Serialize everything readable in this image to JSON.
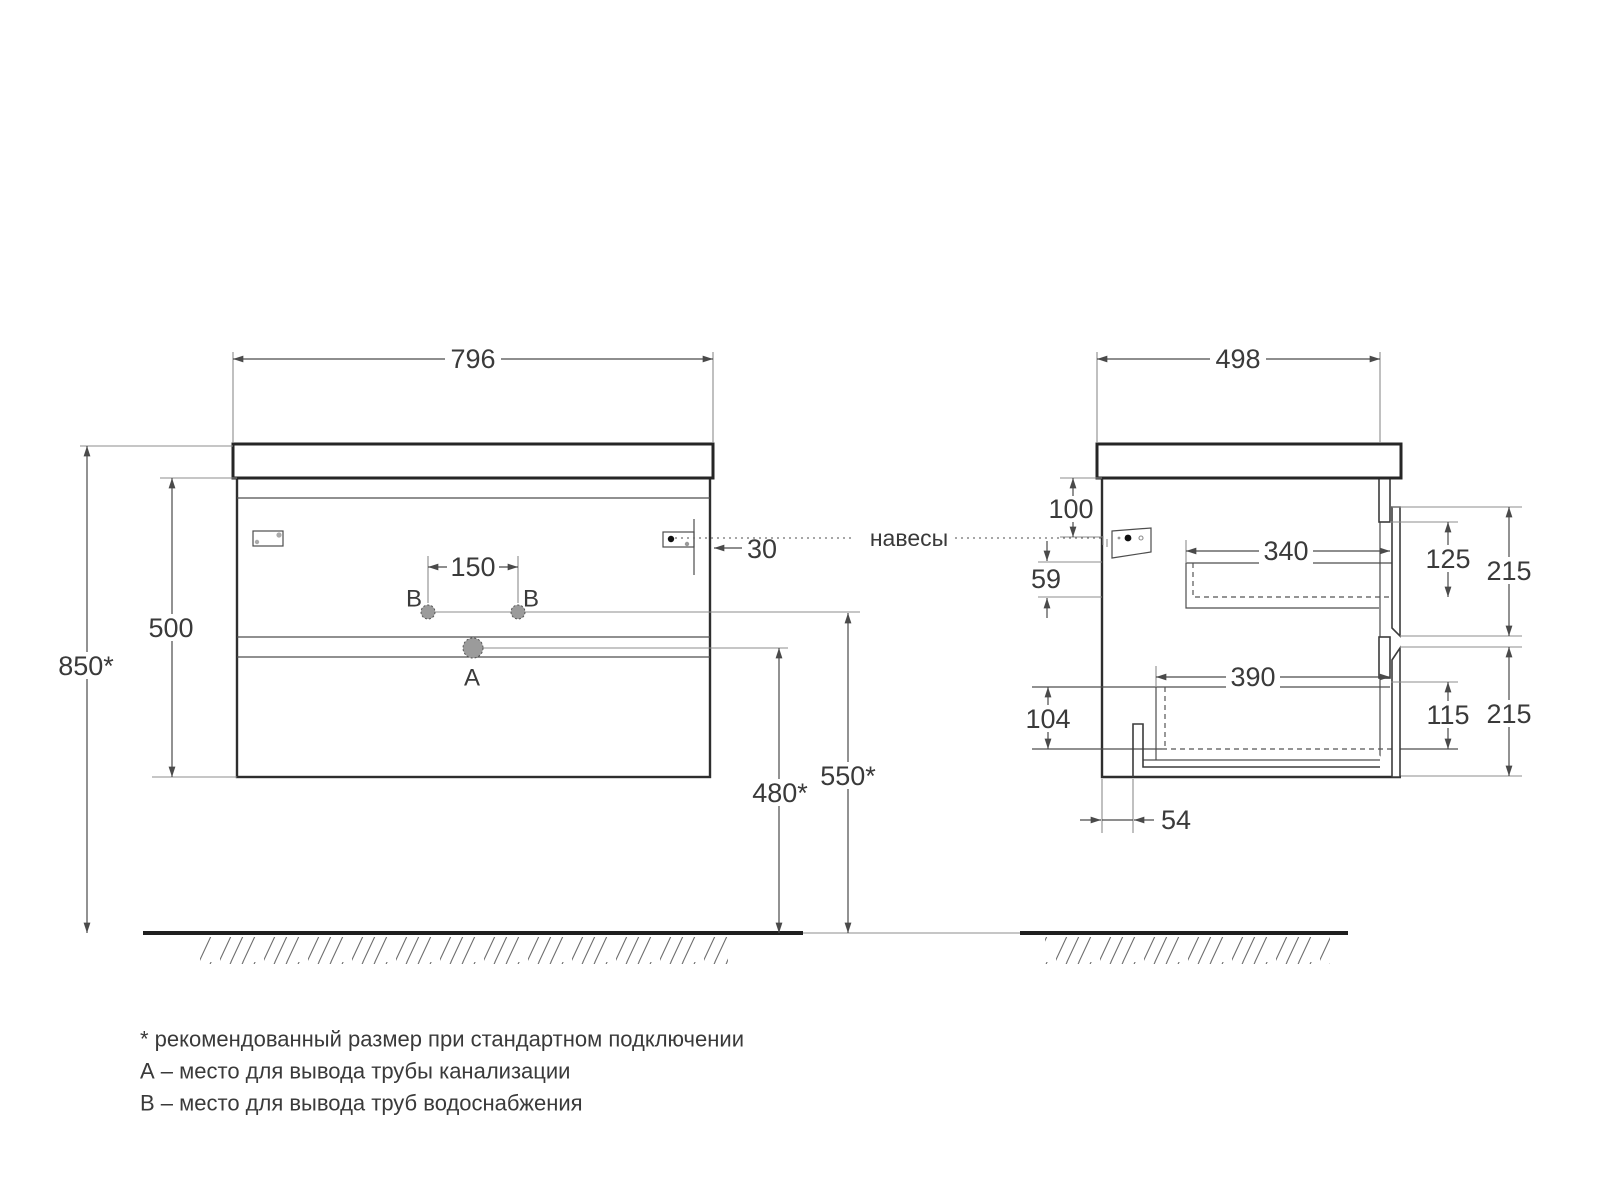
{
  "front_view": {
    "width": "796",
    "overall_height": "850*",
    "cabinet_height": "500",
    "faucet_holes_spacing": "150",
    "hanger_offset": "30",
    "drain_outlet_height": "480*",
    "water_outlet_height": "550*",
    "drain_label": "A",
    "water_label_left": "B",
    "water_label_right": "B"
  },
  "side_view": {
    "depth": "498",
    "hanger_top_offset": "100",
    "upper_drawer_inner_height": "59",
    "upper_drawer_depth": "340",
    "upper_front_recess": "125",
    "upper_front_height": "215",
    "lower_drawer_depth": "390",
    "lower_drawer_inner_height": "104",
    "lower_front_recess": "115",
    "lower_front_height": "215",
    "trap_offset": "54"
  },
  "callout": {
    "hangers": "навесы"
  },
  "notes": [
    "* рекомендованный размер при стандартном подключении",
    "А – место для вывода трубы канализации",
    "В – место для вывода труб водоснабжения"
  ],
  "colors": {
    "outline": "#262626",
    "dimension": "#4a4a4a",
    "auxiliary": "#8c8c8c",
    "text": "#3a3a3a",
    "hole_fill": "#9b9b9b"
  }
}
